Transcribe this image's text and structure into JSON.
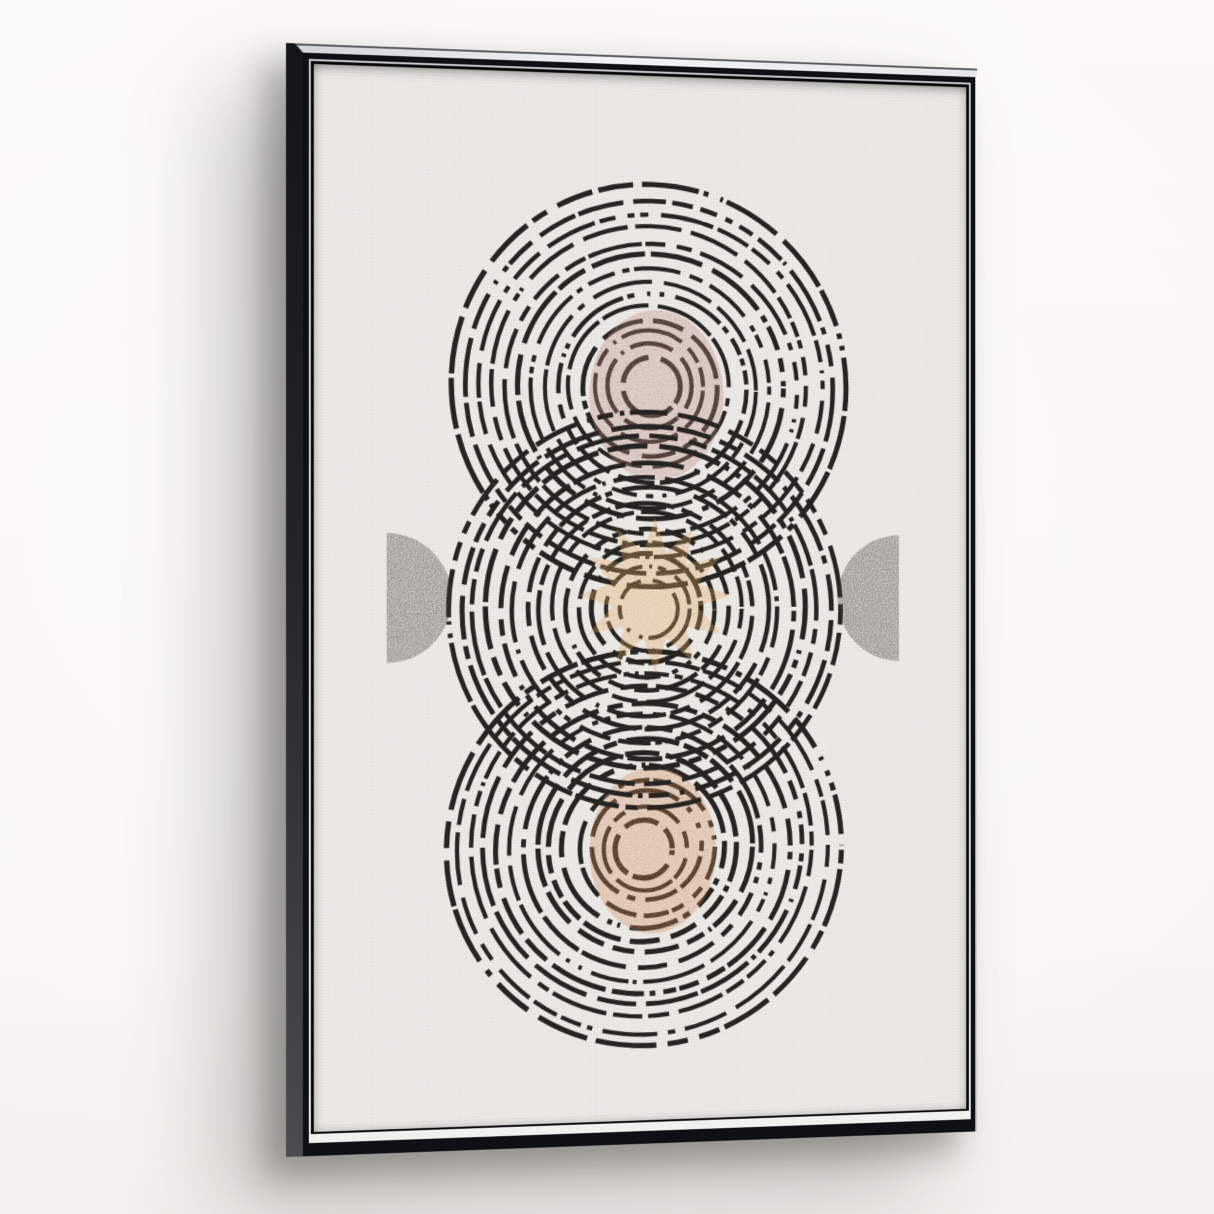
{
  "scene": {
    "description": "Product photo of an abstract mid-century wall art print in a black floating frame with silver inner lip, hung on a pale wall and photographed at a slight left angle with a soft shadow",
    "artwork_style": "hand-inked dashed concentric circle motifs with sun star, rose and terracotta moons, and charcoal half circles"
  },
  "palette_css_vars": {
    "--wall": "#faf9f7",
    "--frame-black": "#0f1013",
    "--frame-side-top": "#141517",
    "--frame-side-bottom": "#4b4c4e",
    "--frame-top-face": "#f2f3f5",
    "--frame-lip": "#f0f0ef",
    "--frame-gap": "#0a0a0a",
    "--canvas": "#edebe7"
  },
  "artwork": {
    "seed": 20240711,
    "ink": "#262420",
    "stroke_width": 4.6,
    "viewbox": "0 0 680 1080",
    "elements": {
      "rings_top": {
        "type": "rings",
        "name": "ring-motif-top",
        "cx": 344,
        "cy": 322,
        "r_min": 30,
        "r_max": 206,
        "count": 14
      },
      "rings_bottom": {
        "type": "rings",
        "name": "ring-motif-bottom",
        "cx": 338,
        "cy": 797,
        "r_min": 30,
        "r_max": 206,
        "count": 14
      },
      "oval_top": {
        "type": "ellipse",
        "name": "rose-moon",
        "cx": 350,
        "cy": 330,
        "rx": 70,
        "ry": 88,
        "fill": "#bb8781"
      },
      "oval_bottom": {
        "type": "ellipse",
        "name": "terracotta-moon",
        "cx": 346,
        "cy": 801,
        "rx": 66,
        "ry": 86,
        "fill": "#d08a5e"
      },
      "rings_middle": {
        "type": "rings",
        "name": "ring-motif-middle",
        "cx": 340,
        "cy": 551,
        "r_min": 30,
        "r_max": 206,
        "count": 14
      },
      "star": {
        "type": "star",
        "name": "sun-star",
        "cx": 348,
        "cy": 537,
        "points": 12,
        "r_outer": 80,
        "r_inner": 46,
        "rotation": 0,
        "fill": "#e2a765"
      },
      "half_left": {
        "type": "half_disc",
        "name": "half-moon-left",
        "cx": 73,
        "cy": 540,
        "r": 66,
        "side": "left",
        "fill": "#3a3733"
      },
      "half_right": {
        "type": "half_disc",
        "name": "half-moon-right",
        "cx": 607,
        "cy": 540,
        "r": 66,
        "side": "right",
        "fill": "#3a3733"
      }
    },
    "z_order": [
      "rings_top",
      "rings_bottom",
      "oval_top",
      "oval_bottom",
      "rings_middle",
      "star",
      "half_left",
      "half_right"
    ]
  }
}
